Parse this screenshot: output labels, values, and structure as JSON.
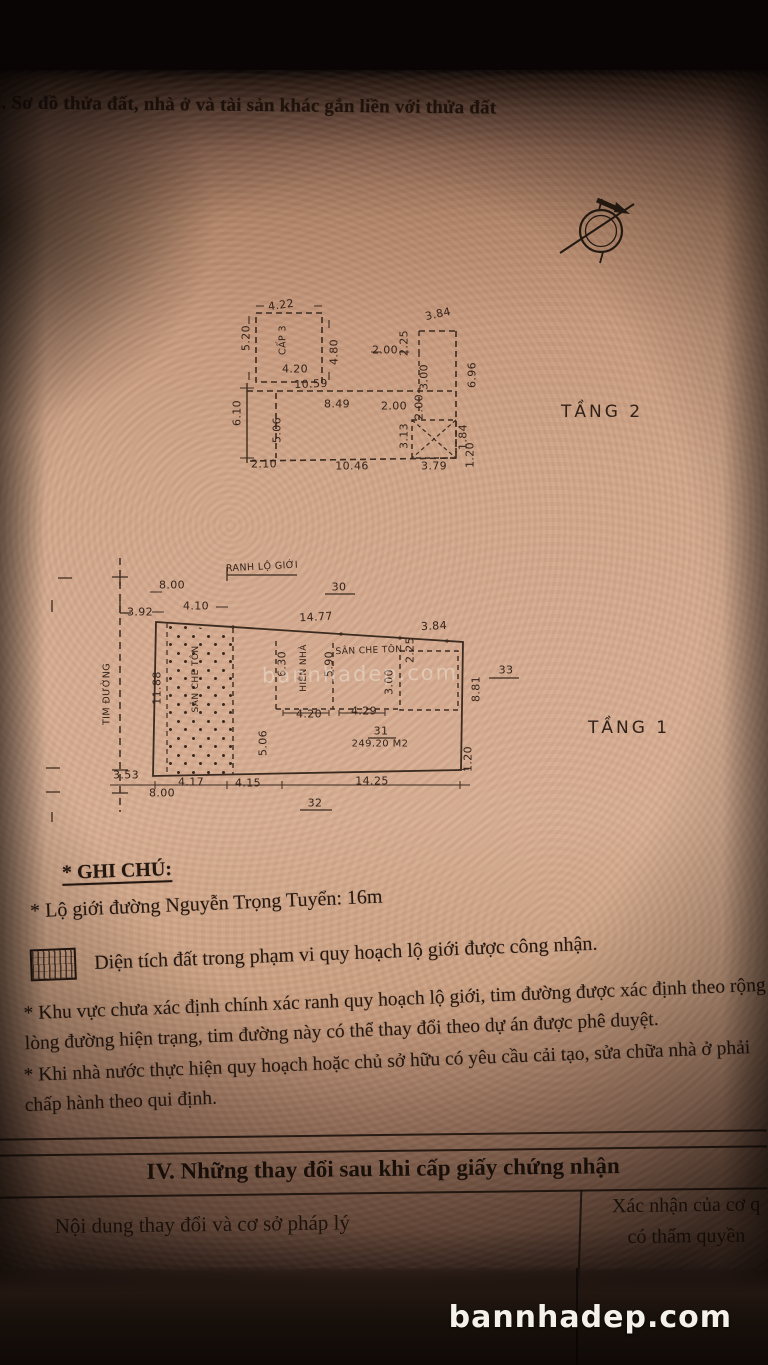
{
  "page": {
    "section_title": "I. Sơ đồ thửa đất, nhà ở và tài sản khác gắn liền với thửa đất",
    "watermark": "bannhadep.com",
    "footer_watermark": "bannhadep.com"
  },
  "floor2": {
    "name": "TẦNG 2",
    "labels": [
      {
        "t": "4.22",
        "x": 281,
        "y": 305,
        "r": -8
      },
      {
        "t": "5.20",
        "x": 246,
        "y": 338,
        "r": -90
      },
      {
        "t": "CẤP 3",
        "x": 283,
        "y": 340,
        "r": -90,
        "fs": 9.5
      },
      {
        "t": "4.80",
        "x": 334,
        "y": 352,
        "r": -90
      },
      {
        "t": "4.20",
        "x": 295,
        "y": 369,
        "r": 0
      },
      {
        "t": "10.59",
        "x": 311,
        "y": 384,
        "r": -2
      },
      {
        "t": "8.49",
        "x": 337,
        "y": 404,
        "r": 0
      },
      {
        "t": "2.00",
        "x": 385,
        "y": 350,
        "r": 0
      },
      {
        "t": "2.00",
        "x": 394,
        "y": 406,
        "r": 0
      },
      {
        "t": "6.10",
        "x": 237,
        "y": 413,
        "r": -90
      },
      {
        "t": "5.06",
        "x": 277,
        "y": 430,
        "r": -90
      },
      {
        "t": "2.10",
        "x": 264,
        "y": 464,
        "r": 0
      },
      {
        "t": "10.46",
        "x": 352,
        "y": 466,
        "r": 0
      },
      {
        "t": "3.79",
        "x": 434,
        "y": 466,
        "r": 0
      },
      {
        "t": "3.84",
        "x": 438,
        "y": 314,
        "r": -12
      },
      {
        "t": "2.25",
        "x": 404,
        "y": 343,
        "r": -90
      },
      {
        "t": "3.00",
        "x": 424,
        "y": 377,
        "r": -90
      },
      {
        "t": "2.00",
        "x": 419,
        "y": 407,
        "r": -90
      },
      {
        "t": "6.96",
        "x": 472,
        "y": 375,
        "r": -90
      },
      {
        "t": "3.13",
        "x": 404,
        "y": 436,
        "r": -90
      },
      {
        "t": "1.84",
        "x": 463,
        "y": 437,
        "r": -90
      },
      {
        "t": "1.20",
        "x": 470,
        "y": 455,
        "r": -90
      }
    ]
  },
  "floor1": {
    "name": "TẦNG 1",
    "lot_number": "31",
    "lot_area": "249.20 M2",
    "labels": [
      {
        "t": "RANH LỘ GIỚI",
        "x": 262,
        "y": 567,
        "r": -3,
        "fs": 9.5
      },
      {
        "t": "8.00",
        "x": 172,
        "y": 585,
        "r": 0
      },
      {
        "t": "30",
        "x": 339,
        "y": 587,
        "r": 0
      },
      {
        "t": "3.92",
        "x": 140,
        "y": 612,
        "r": 0
      },
      {
        "t": "4.10",
        "x": 196,
        "y": 606,
        "r": 0
      },
      {
        "t": "14.77",
        "x": 316,
        "y": 617,
        "r": -3
      },
      {
        "t": "3.84",
        "x": 434,
        "y": 626,
        "r": -3
      },
      {
        "t": "TIM ĐƯỜNG",
        "x": 107,
        "y": 694,
        "r": -90,
        "fs": 9.5
      },
      {
        "t": "11.88",
        "x": 157,
        "y": 688,
        "r": -90
      },
      {
        "t": "SÂN CHE TÔN",
        "x": 196,
        "y": 679,
        "r": -90,
        "fs": 9
      },
      {
        "t": "6.30",
        "x": 282,
        "y": 664,
        "r": -90
      },
      {
        "t": "HIÊN NHÀ",
        "x": 304,
        "y": 668,
        "r": -90,
        "fs": 9
      },
      {
        "t": "5.90",
        "x": 329,
        "y": 664,
        "r": -90
      },
      {
        "t": "SÂN CHE TÔN",
        "x": 369,
        "y": 651,
        "r": -2,
        "fs": 9
      },
      {
        "t": "2.25",
        "x": 410,
        "y": 650,
        "r": -90
      },
      {
        "t": "3.00",
        "x": 389,
        "y": 682,
        "r": -90
      },
      {
        "t": "4.20",
        "x": 309,
        "y": 714,
        "r": 0
      },
      {
        "t": "4.29",
        "x": 364,
        "y": 711,
        "r": 0
      },
      {
        "t": "8.81",
        "x": 476,
        "y": 689,
        "r": -90
      },
      {
        "t": "33",
        "x": 506,
        "y": 670,
        "r": 0
      },
      {
        "t": "5.06",
        "x": 263,
        "y": 743,
        "r": -90
      },
      {
        "t": "31",
        "x": 381,
        "y": 731,
        "r": 0
      },
      {
        "t": "249.20 M2",
        "x": 380,
        "y": 744,
        "r": 0,
        "fs": 10
      },
      {
        "t": "3.53",
        "x": 126,
        "y": 775,
        "r": 0
      },
      {
        "t": "4.17",
        "x": 191,
        "y": 782,
        "r": 0
      },
      {
        "t": "4.15",
        "x": 248,
        "y": 783,
        "r": 0
      },
      {
        "t": "14.25",
        "x": 372,
        "y": 781,
        "r": 0
      },
      {
        "t": "8.00",
        "x": 162,
        "y": 793,
        "r": 0
      },
      {
        "t": "1.20",
        "x": 468,
        "y": 759,
        "r": -90
      },
      {
        "t": "32",
        "x": 315,
        "y": 803,
        "r": 0
      }
    ]
  },
  "notes": {
    "heading": "* GHI CHÚ:",
    "road_limit": "* Lộ giới đường Nguyễn Trọng Tuyển: 16m",
    "legend": "Diện tích đất trong phạm vi quy hoạch lộ giới được công nhận.",
    "para1": "* Khu vực chưa xác định chính xác ranh quy hoạch lộ giới, tim đường được xác định theo rộng lòng đường hiện trạng, tim đường này có thể thay đổi theo dự án được phê duyệt.",
    "para2": "* Khi nhà nước thực hiện quy hoạch hoặc chủ sở hữu có yêu cầu cải tạo, sửa chữa nhà ở phải chấp hành theo qui định."
  },
  "table": {
    "title": "IV. Những thay đổi sau khi cấp giấy chứng nhận",
    "col_left": "Nội dung thay đổi và cơ sở pháp lý",
    "col_right_line1": "Xác nhận của cơ q",
    "col_right_line2": "có thẩm quyền"
  },
  "colors": {
    "paper": "#d6ac91",
    "ink": "#241710",
    "plan_stroke": "#3b2a1f",
    "footer_text": "#f4f1ea"
  }
}
